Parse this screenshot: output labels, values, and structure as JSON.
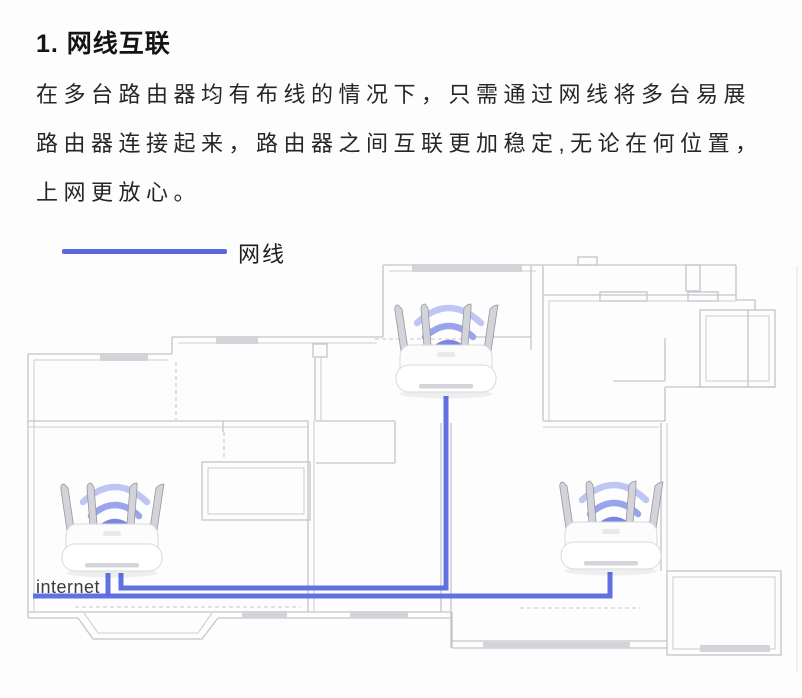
{
  "section": {
    "title": "1. 网线互联",
    "body_lines": [
      "在多台路由器均有布线的情况下，只需通过网线将多台易展",
      "路由器连接起来，路由器之间互联更加稳定,无论在何位置，",
      "上网更放心。"
    ]
  },
  "legend": {
    "label": "网线",
    "line_color": "#5a69e0"
  },
  "floorplan": {
    "internet_label": "internet",
    "colors": {
      "wall": "#c5c5cb",
      "window_fill": "#d4d4d8",
      "cable": "#5a69e0",
      "wifi": "#7b86e2"
    },
    "routers": [
      {
        "id": "router-top",
        "position": "top-room"
      },
      {
        "id": "router-left",
        "position": "left-room",
        "label": "internet"
      },
      {
        "id": "router-right",
        "position": "right-room"
      }
    ],
    "cables": [
      {
        "id": "cable-internet",
        "from": "left-wall",
        "to": "router-left"
      },
      {
        "id": "cable-left-to-top",
        "from": "router-left",
        "to": "router-top"
      },
      {
        "id": "cable-left-to-right",
        "from": "router-left",
        "to": "router-right"
      }
    ]
  }
}
